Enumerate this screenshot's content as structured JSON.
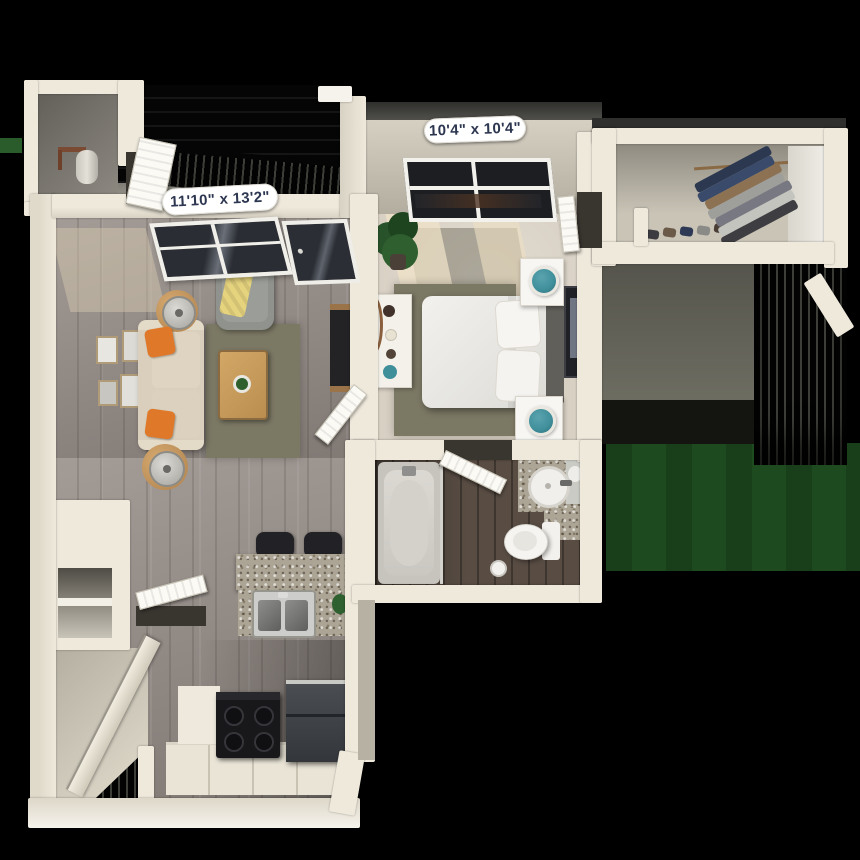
{
  "labels": {
    "living_room_dimensions": "11'10\" x 13'2\"",
    "bedroom_dimensions": "10'4\" x 10'4\""
  },
  "palette": {
    "background": "#000000",
    "wall": "#efe9dc",
    "wood_floor": "#99908a",
    "dark_wood_floor": "#584c43",
    "carpet": "#d8d0c3",
    "rug_olive": "#7b7864",
    "sofa_beige": "#d9cfbc",
    "pillow_orange": "#e0782a",
    "throw_yellow": "#e5d37e",
    "lamp_teal": "#3f8f9b",
    "table_wood": "#c89a66",
    "granite": "#aca595",
    "grass": "#1d4a1e",
    "appliance_black": "#18181b",
    "fridge_gray": "#33363a",
    "label_bg": "#ffffff",
    "label_text": "#2d3650"
  }
}
